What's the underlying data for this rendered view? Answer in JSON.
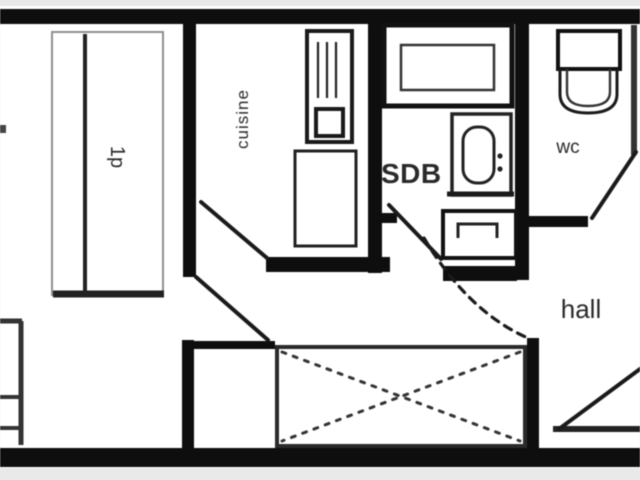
{
  "plan": {
    "rooms": [
      {
        "name": "bedroom",
        "label": "1p"
      },
      {
        "name": "kitchen",
        "label": "cuisine"
      },
      {
        "name": "bathroom",
        "label": "SDB"
      },
      {
        "name": "wc",
        "label": "wc"
      },
      {
        "name": "hall",
        "label": "hall"
      }
    ]
  },
  "colors": {
    "wall": "#0e0e0e",
    "paper": "#ffffff",
    "margin": "#e9e9e9",
    "ink": "#222222",
    "light_line": "#8f8f8f"
  }
}
